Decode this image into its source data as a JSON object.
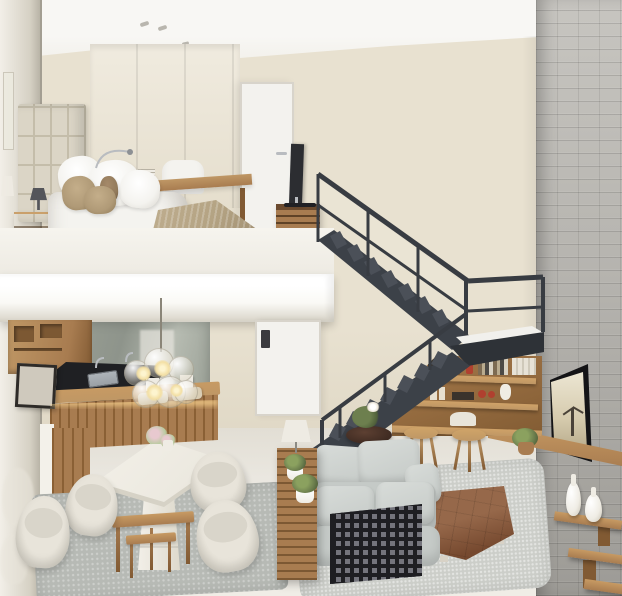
{
  "image_type": "3d-render photograph of a duplex loft apartment interior, no visible text",
  "palette": {
    "wall-cream": "#e8e1d0",
    "wall-cream-dark": "#ddd5c2",
    "ceiling-white": "#f8f7f4",
    "brick-base": "#b6b4af",
    "brick-light": "#c7c5c0",
    "brick-dark": "#9d9b96",
    "floor-light": "#eae7e0",
    "mezz-white": "#faf9f5",
    "fascia-edge": "#dcd8cd",
    "mirror-light": "#f2efe8",
    "mirror-dark": "#d6d1c4",
    "stair-dark": "#3c4148",
    "stair-darker": "#2e3237",
    "stair-mid": "#4b5058",
    "rail-color": "#383c42",
    "landing-floor": "#f1f0ec",
    "headboard": "#dbd5c6",
    "headboard-seam": "#c4bdaa",
    "bed-white": "#f4f3ef",
    "bed-shadow": "#d9d6cf",
    "pillow-tan": "#b09a77",
    "pillow-brown": "#937b5c",
    "throw-tan": "#b4a383",
    "wood": "#a87c50",
    "wood-dark": "#815a33",
    "wood-light": "#bf9765",
    "door-white": "#f3f2ee",
    "door-frame": "#d8d4cb",
    "tv-dark": "#2c2d31",
    "chrome": "#b9bcc0",
    "counter-dark": "#1f2023",
    "sink-steel": "#9aa0a5",
    "backsplash-a": "#9aa096",
    "backsplash-b": "#b7bcb2",
    "glow-warm": "#ffd993",
    "bulb-warm": "#f3dfa4",
    "table-white": "#ece9e0",
    "table-edge": "#d6d2c6",
    "chair-cream": "#e8e4da",
    "chair-shadow": "#c9c5b9",
    "rug-dining": "#b7bab5",
    "rug-living": "#cccec9",
    "rug-bedroom": "#c7c8c4",
    "sofa-gray": "#c5cac7",
    "sofa-light": "#d8dcd9",
    "lattice-dark": "#1e1e22",
    "lattice-light": "#74747c",
    "ottoman-brown": "#8c5e41",
    "ottoman-dark": "#76492f",
    "plant-green": "#6d7f4e",
    "plant-dark": "#50603a",
    "vase-white": "#efece4",
    "screen-light": "#d6cbae",
    "screen-dark": "#b3a686",
    "figure-dark": "#4a4238",
    "accent-red": "#b0402f",
    "lamp-white": "#eeebe3"
  },
  "scene": {
    "areas": {
      "mezzanine_bedroom": [
        "mirror wall",
        "quilted headboard",
        "double bed with white duvet",
        "white pillows",
        "tan pillows",
        "knitted tan throw",
        "wood nightstand",
        "small dark lamp",
        "wood desk",
        "white desk chair",
        "arc desk lamp",
        "book stack",
        "cream wardrobe",
        "white door",
        "flat tv on wood slat cabinet",
        "gray rug",
        "recessed ceiling lights"
      ],
      "staircase": [
        "charcoal steel switchback stair",
        "upper flight",
        "lower flight",
        "landing platform",
        "thin metal railings with glass"
      ],
      "kitchen": [
        "wood upper cabinets",
        "mirror backsplash",
        "black countertop with sink",
        "wood island with warm under-counter glow",
        "glass bubble pendant lamp",
        "placemats",
        "framed art"
      ],
      "dining_area": [
        "white pedestal dining table",
        "four cream tub chairs",
        "pink flower pots",
        "wood nesting tables",
        "gray rug",
        "mirror reflections of chairs"
      ],
      "living_area": [
        "light gray sofa",
        "black lattice sofa side panel",
        "brown leather tufted ottoman",
        "wood console with white lamp and plants",
        "dark round side table with orchid",
        "wood tripod stools",
        "light gray rug"
      ],
      "right_wall": [
        "gray brick wall",
        "wall mounted tv with sepia scene",
        "wood bench",
        "under-stair wood shelves with books, candles and red accents",
        "staggered wall shelves",
        "white ceramic vases",
        "potted plant",
        "ground floor white door with lock"
      ]
    }
  }
}
